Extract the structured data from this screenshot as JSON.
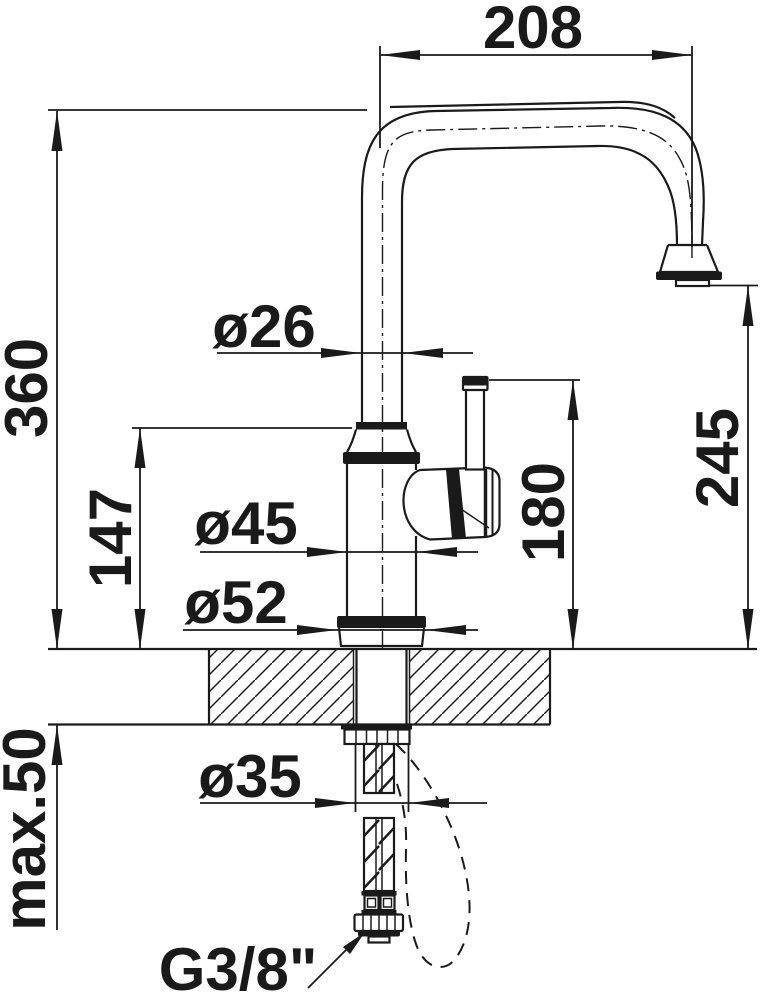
{
  "colors": {
    "ink": "#1a1a1a",
    "background": "#ffffff"
  },
  "dimension_labels": {
    "spout_reach": "208",
    "overall_height": "360",
    "body_top_height": "147",
    "max_counter_thickness": "max.50",
    "spout_pipe_diameter": "ø26",
    "body_diameter": "ø45",
    "base_diameter": "ø52",
    "mounting_hole_diameter": "ø35",
    "lever_top_height": "180",
    "outlet_height": "245",
    "supply_connection_thread": "G3/8\""
  }
}
